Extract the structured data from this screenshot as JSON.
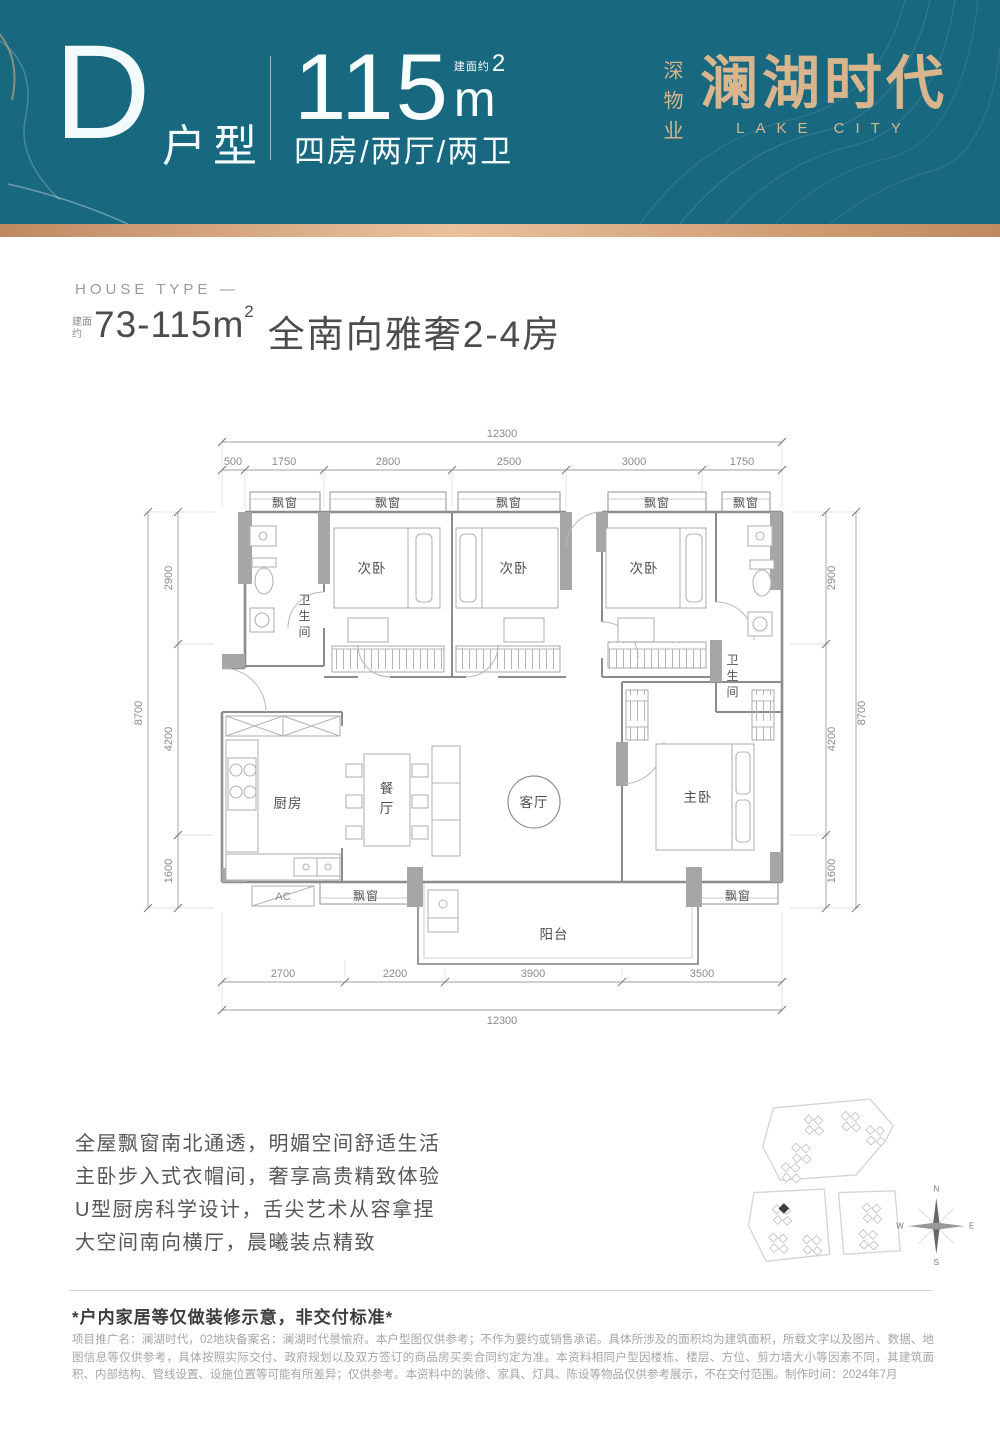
{
  "header": {
    "type_letter": "D",
    "type_label": "户型",
    "area_value": "115",
    "area_prefix": "建面约",
    "area_unit": "m",
    "area_sup": "2",
    "layout_text": "四房/两厅/两卫",
    "brand_cn_vertical": "深物业",
    "brand_cn": "澜湖时代",
    "brand_en": "LAKE CITY"
  },
  "intro": {
    "eyebrow": "HOUSE TYPE —",
    "area_note_line1": "建面",
    "area_note_line2": "约",
    "range": "73-115m",
    "range_sup": "2",
    "headline": "全南向雅奢2-4房"
  },
  "floor_plan": {
    "rooms": {
      "bay_window": "飘窗",
      "bedroom2": "次卧",
      "bathroom": [
        "卫",
        "生",
        "间"
      ],
      "kitchen": "厨房",
      "dining": [
        "餐",
        "厅"
      ],
      "living": "客厅",
      "master": "主卧",
      "balcony": "阳台",
      "ac": "AC"
    },
    "dimensions": {
      "top_total": "12300",
      "top_segments": [
        "500",
        "1750",
        "2800",
        "2500",
        "3000",
        "1750"
      ],
      "bottom_segments": [
        "2700",
        "2200",
        "3900",
        "3500"
      ],
      "bottom_total": "12300",
      "left_total": "8700",
      "left_segments": [
        "2900",
        "4200",
        "1600"
      ],
      "right_total": "8700",
      "right_segments": [
        "2900",
        "4200",
        "1600"
      ]
    }
  },
  "features": [
    "全屋飘窗南北通透，明媚空间舒适生活",
    "主卧步入式衣帽间，奢享高贵精致体验",
    "U型厨房科学设计，舌尖艺术从容拿捏",
    "大空间南向横厅，晨曦装点精致"
  ],
  "site_map": {
    "compass": {
      "n": "N",
      "e": "E",
      "s": "S",
      "w": "W"
    }
  },
  "footer": {
    "notice": "*户内家居等仅做装修示意，非交付标准*",
    "disclaimer": "项目推广名：澜湖时代，02地块备案名：澜湖时代景愉府。本户型图仅供参考；不作为要约或销售承诺。具体所涉及的面积均为建筑面积，所载文字以及图片、数据、地图信息等仅供参考，具体按照实际交付、政府规划以及双方签订的商品房买卖合同约定为准。本资料相同户型因楼栋、楼层、方位、剪力墙大小等因素不同，其建筑面积、内部结构、管线设置、设施位置等可能有所差异；仅供参考。本资料中的装修、家具、灯具、陈设等物品仅供参考展示，不在交付范围。制作时间：2024年7月"
  }
}
